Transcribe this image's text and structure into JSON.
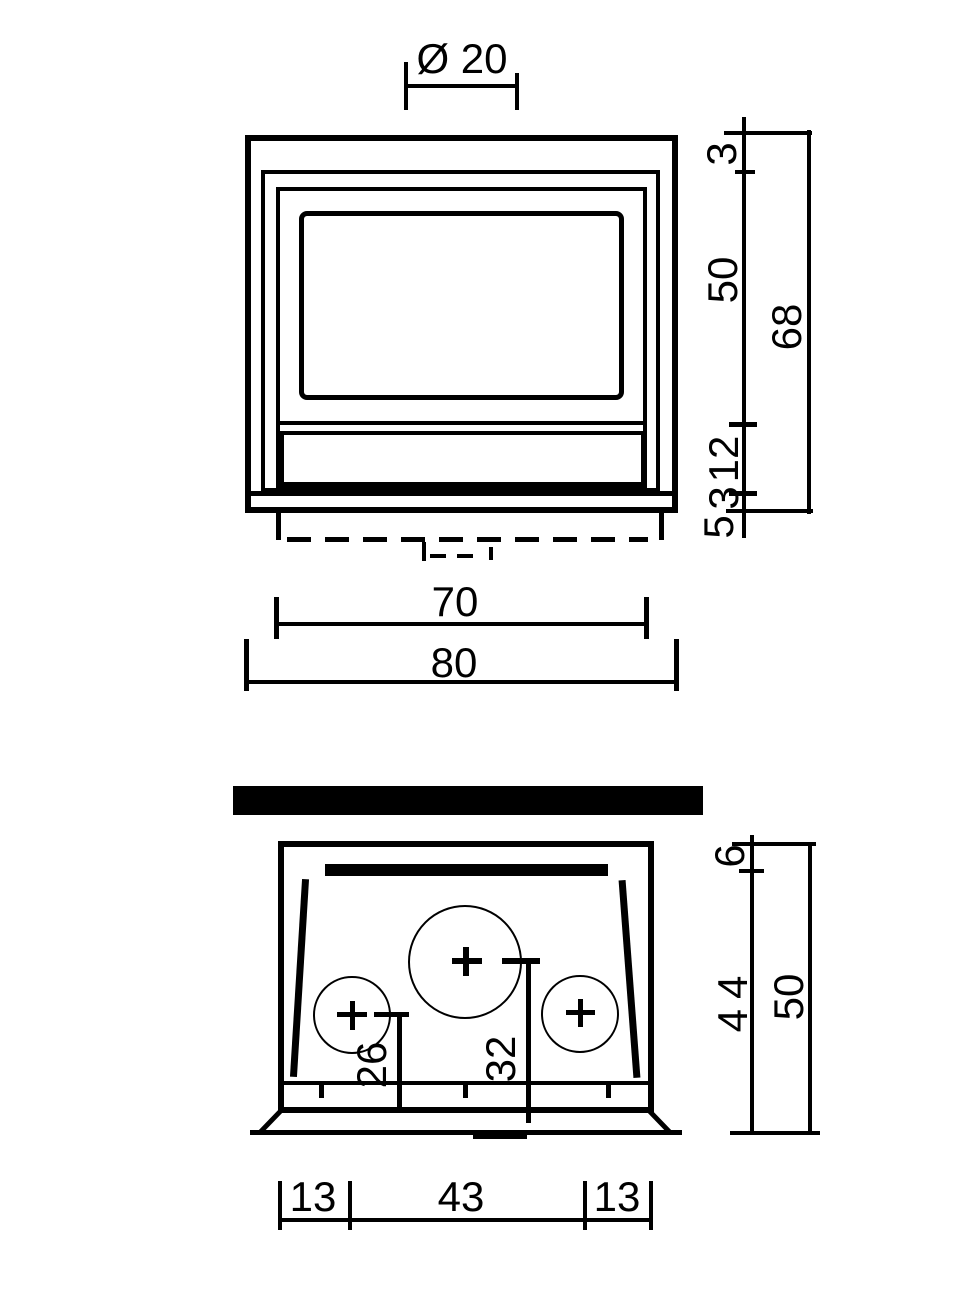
{
  "front_view": {
    "labels": {
      "diameter": "Ø 20",
      "top_inset": "3",
      "window_height": "50",
      "overall_height": "68",
      "panel_height": "12",
      "base_height": "3",
      "plinth_height": "5",
      "inner_width": "70",
      "overall_width": "80"
    }
  },
  "plan_view": {
    "labels": {
      "back_inset": "6",
      "inner_depth": "44",
      "overall_depth": "50",
      "left_outlet_offset": "26",
      "center_outlet_offset": "32",
      "left_width": "13",
      "center_width": "43",
      "right_width": "13"
    }
  }
}
